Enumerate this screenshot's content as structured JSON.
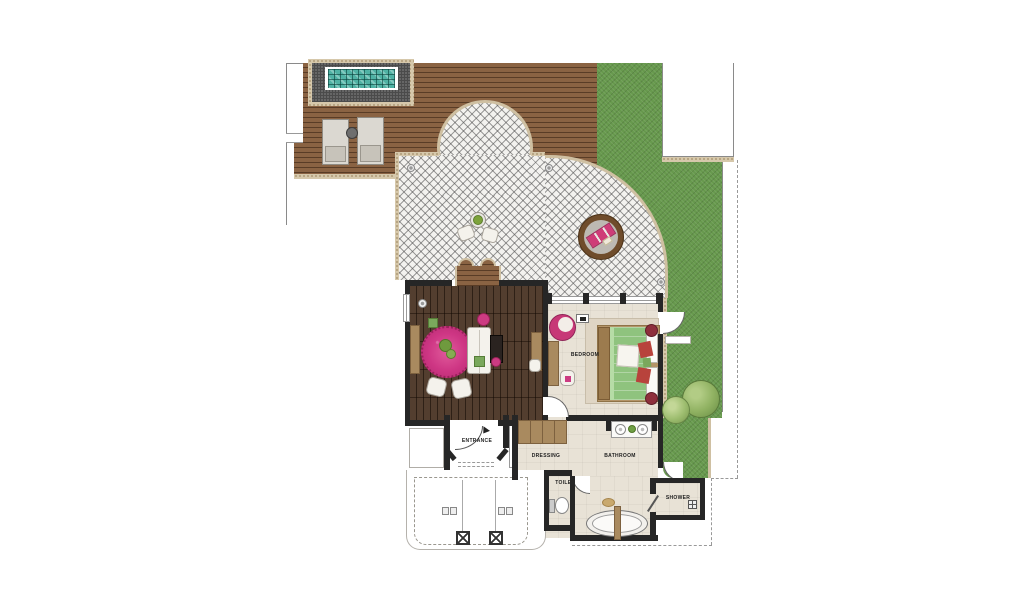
{
  "plan": {
    "title": "villa-suite-floor-plan",
    "labels": {
      "bedroom": "BEDROOM",
      "entrance": "ENTRANCE",
      "dressing": "DRESSING",
      "bathroom": "BATHROOM",
      "toilet": "TOILET",
      "shower": "SHOWER"
    },
    "areas": [
      "pool",
      "sun-deck",
      "terrace",
      "garden",
      "living-room",
      "bedroom",
      "entrance",
      "dressing",
      "bathroom",
      "toilet",
      "shower",
      "porch"
    ],
    "colors": {
      "grass": "#67994d",
      "deck_wood": "#8a6343",
      "living_floor": "#4a3424",
      "light_floor": "#e8e2d6",
      "pool_water": "#4fb2a4",
      "terrace": "#f3f2ef",
      "pebble_border": "#d6c8ab",
      "wall": "#262626",
      "rug_pink": "#d23f8a",
      "bed_green": "#8fc37e",
      "accent_red": "#b8433c"
    }
  }
}
